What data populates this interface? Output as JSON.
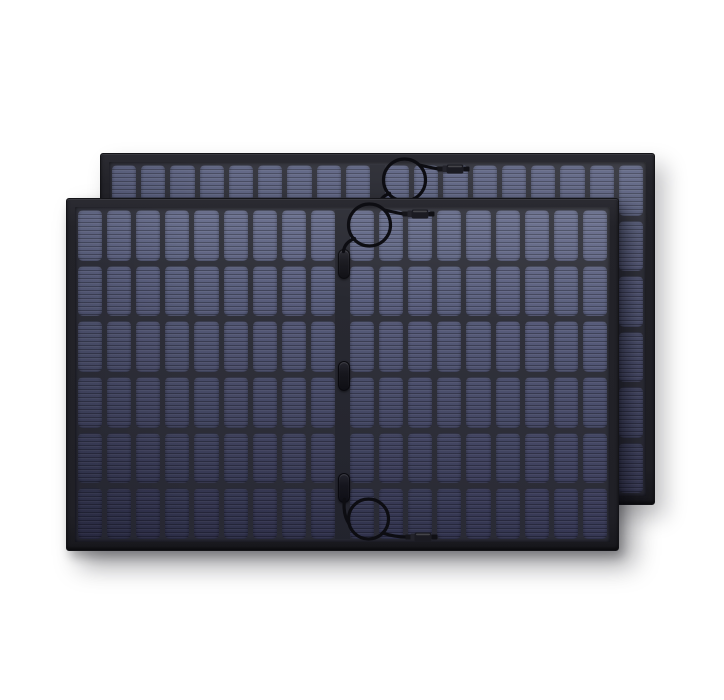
{
  "scene": {
    "type": "product-photo",
    "subject": "Two black-framed rigid solar panels overlapping, front panel lower-left of back panel",
    "panel_count": 2,
    "background_color": "#ffffff"
  },
  "panels": [
    {
      "name": "solar-panel-back",
      "x": 100,
      "y": 153,
      "width": 555,
      "height": 352,
      "rows": 6,
      "columns_per_half": 9,
      "cell_color_top": "#5f6584",
      "cell_color_bottom": "#434562",
      "has_top_cable": true,
      "has_bottom_cable": false,
      "junction_pill_count": 3
    },
    {
      "name": "solar-panel-front",
      "x": 66,
      "y": 198,
      "width": 553,
      "height": 353,
      "rows": 6,
      "columns_per_half": 9,
      "cell_color_top": "#666c8b",
      "cell_color_bottom": "#3d3f5d",
      "has_top_cable": true,
      "has_bottom_cable": true,
      "junction_pill_count": 3
    }
  ],
  "colors": {
    "frame": "#232329",
    "frame_edge": "#141418",
    "backsheet": "#30313a",
    "center_strip": "#282931",
    "cable": "#0d0d12",
    "connector_body": "#1b1b22",
    "connector_tip": "#101015",
    "connector_ferrule": "#15151a",
    "connector_collar": "#23232b",
    "junction_pill": "#17171d"
  }
}
